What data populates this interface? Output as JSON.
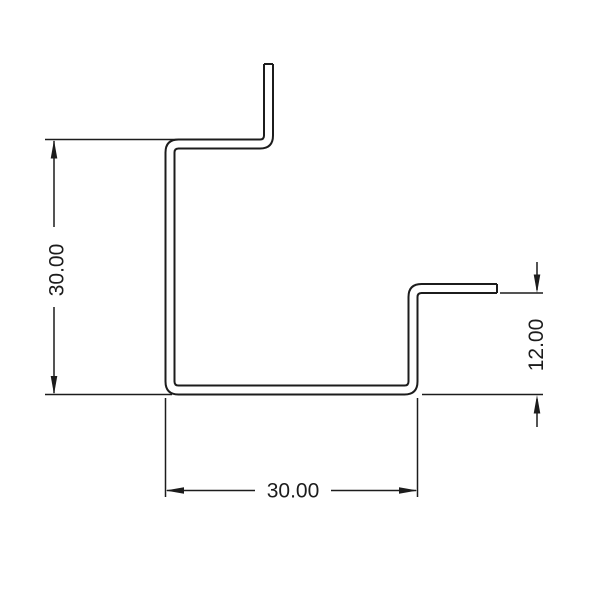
{
  "drawing": {
    "background_color": "#ffffff",
    "line_color": "#1c1c1c",
    "dimensions": {
      "left_height": {
        "label": "30.00",
        "orientation": "vertical"
      },
      "bottom_width": {
        "label": "30.00",
        "orientation": "horizontal"
      },
      "right_flange_height": {
        "label": "12.00",
        "orientation": "vertical"
      }
    }
  }
}
